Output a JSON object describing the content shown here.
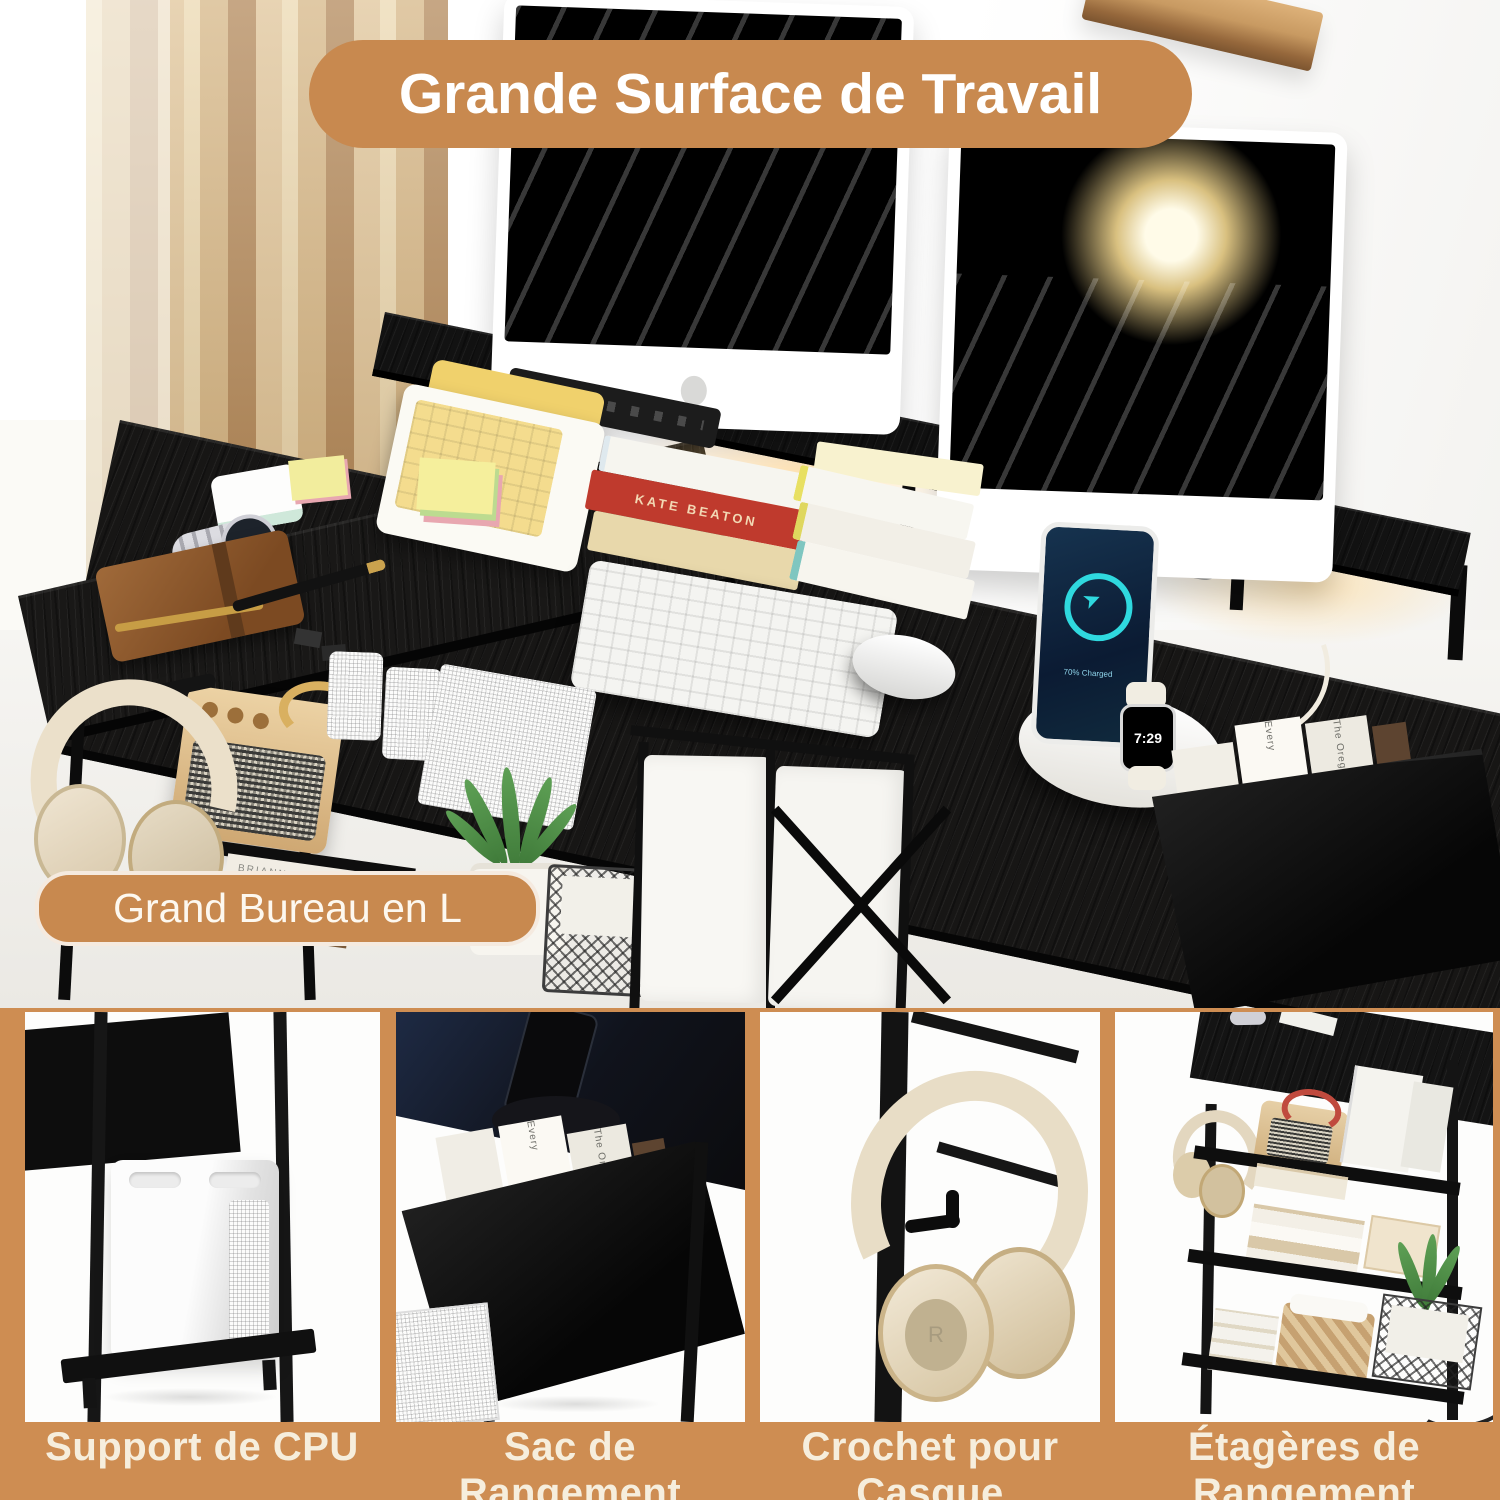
{
  "meta": {
    "language": "fr",
    "kind": "product-infographic-screenshot"
  },
  "colors": {
    "accent_orange": "#C8894F",
    "bottom_background": "#CE8D52",
    "feature_label_text": "#F6EEDD",
    "banner_text": "#FFFFFF",
    "desk_black": "#161616"
  },
  "overlays": {
    "top_banner": "Grande Surface de Travail",
    "desk_label": "Grand Bureau en L"
  },
  "features": [
    {
      "label": "Support de CPU"
    },
    {
      "label": "Sac de Rangement"
    },
    {
      "label": "Crochet pour Casque"
    },
    {
      "label": "Étagères de Rangement"
    }
  ],
  "scene": {
    "watch_time": "7:29",
    "phone_status": "70% Charged",
    "book_spines": [
      "KATE BEATON",
      "BRIANNA WIEST"
    ],
    "magazines": [
      "Every",
      "The Oregonian"
    ],
    "headphone_marking": "R"
  }
}
